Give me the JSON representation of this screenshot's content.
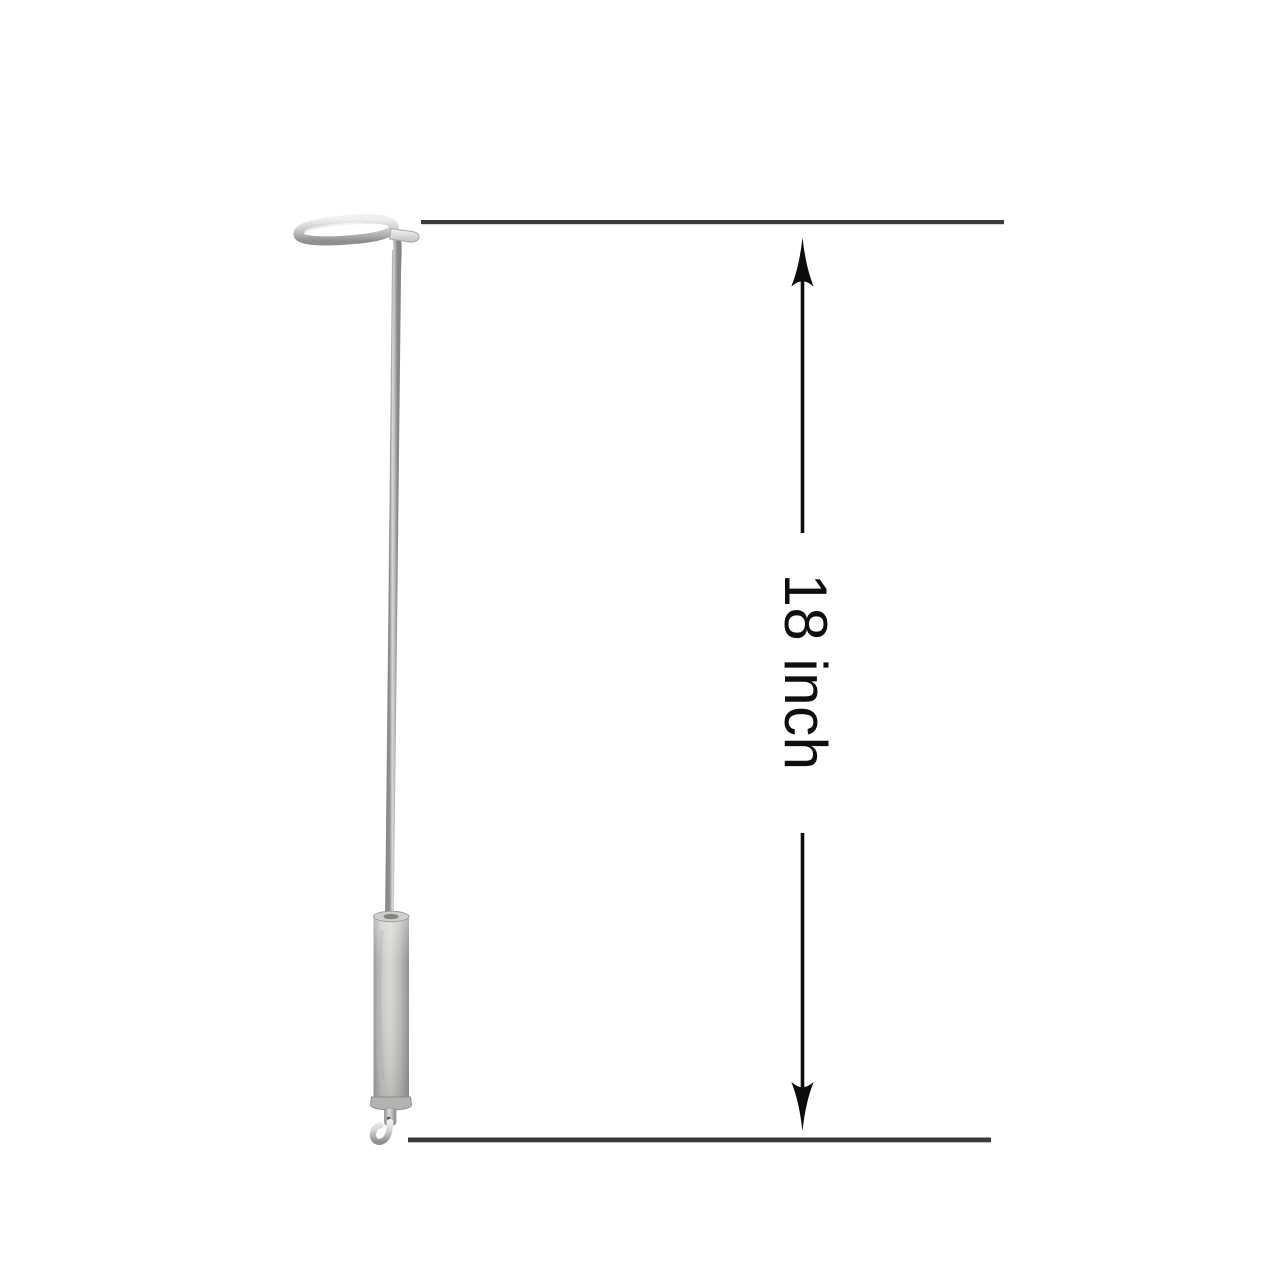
{
  "canvas": {
    "width": 1280,
    "height": 1280,
    "background_color": "#ffffff"
  },
  "product": {
    "description": "stainless steel T-handle rod with cylindrical sleeve and hook tip",
    "metal_highlight_color": "#e9e9e9",
    "metal_mid_color": "#c7c7c5",
    "metal_shadow_color": "#8f8f8f"
  },
  "dimension_annotation": {
    "label": "18 inch",
    "line_color": "#3a3a3a",
    "arrow_color": "#0d0d0d",
    "label_color": "#0e0e0e"
  }
}
